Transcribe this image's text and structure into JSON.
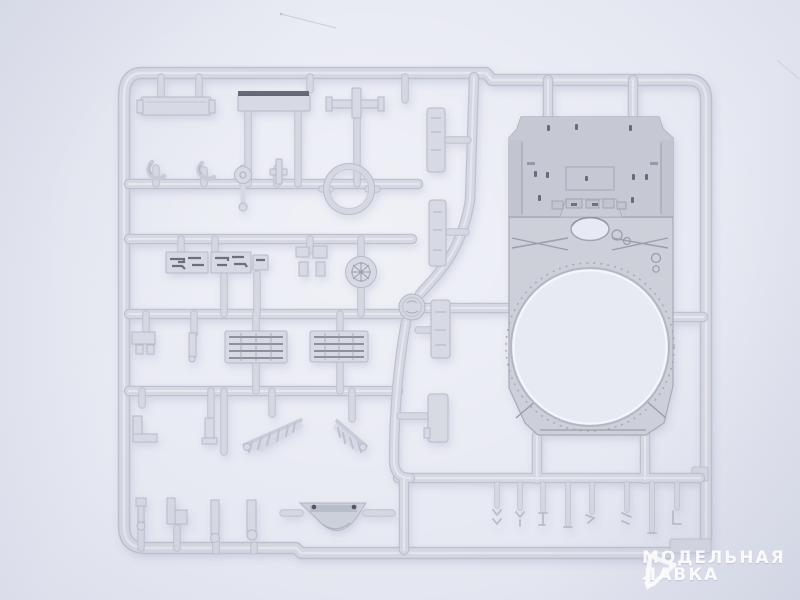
{
  "scene": {
    "subject": "injection-molded plastic model kit sprue with tank upper hull and small detail parts",
    "background": "light lavender studio backdrop"
  },
  "watermark": {
    "line1": "МОДЕЛЬНАЯ",
    "line2": "ЛАВКА",
    "logo": "model-shop-logo"
  },
  "colors": {
    "background": "#e8eaf3",
    "backdrop_edge": "#dde0eb",
    "plastic": "#d5d7e1",
    "plastic_hi": "#e7e9f0",
    "plastic_shadow": "#bec2cf",
    "part_fill": "#d7d9e3",
    "part_edge": "#b7bbc9",
    "hull_fill": "#cdd0d9",
    "hull_deck": "#c6c9d3",
    "hull_edge": "#a8abb8",
    "hull_line": "#9b9eab",
    "dark_detail": "#515561",
    "watermark_color": "#ffffff"
  }
}
